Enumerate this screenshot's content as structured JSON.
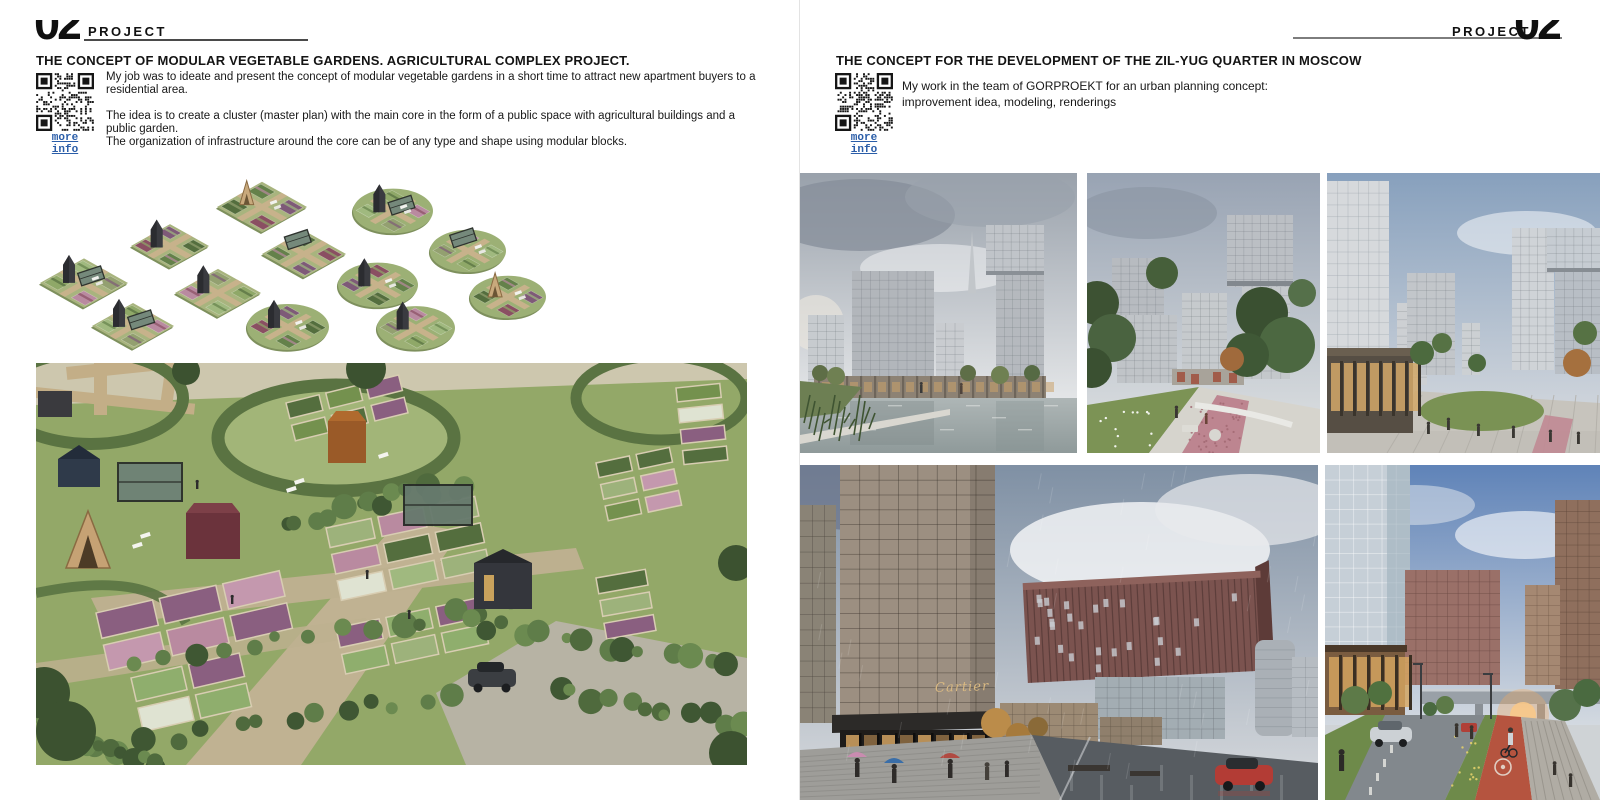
{
  "left": {
    "page_number": "02",
    "header_label": "PROJECT",
    "title": "THE CONCEPT OF MODULAR VEGETABLE GARDENS. AGRICULTURAL COMPLEX PROJECT.",
    "qr_label": "more info",
    "paragraphs": [
      "My job was to ideate and present the concept of modular vegetable gardens in a short time to attract new apartment buyers to a residential area.",
      "The idea is to create a cluster (master plan) with the main core in the form of a public space with agricultural buildings and a public garden.",
      "The organization of infrastructure around the core can be of any type and shape using modular blocks."
    ]
  },
  "right": {
    "page_number": "02",
    "header_label": "PROJECT",
    "title": "THE CONCEPT FOR THE DEVELOPMENT OF THE ZIL-YUG QUARTER IN MOSCOW",
    "qr_label": "more info",
    "paragraphs": [
      "My work in the team of GORPROEKT for an urban planning concept: improvement idea, modeling, renderings"
    ],
    "storefront_sign": "Cartier"
  },
  "colors": {
    "link_blue": "#2a5da8",
    "qr_black": "#161616",
    "accent_maroon": "#7a524e",
    "bike_lane_red": "#b5543f"
  }
}
